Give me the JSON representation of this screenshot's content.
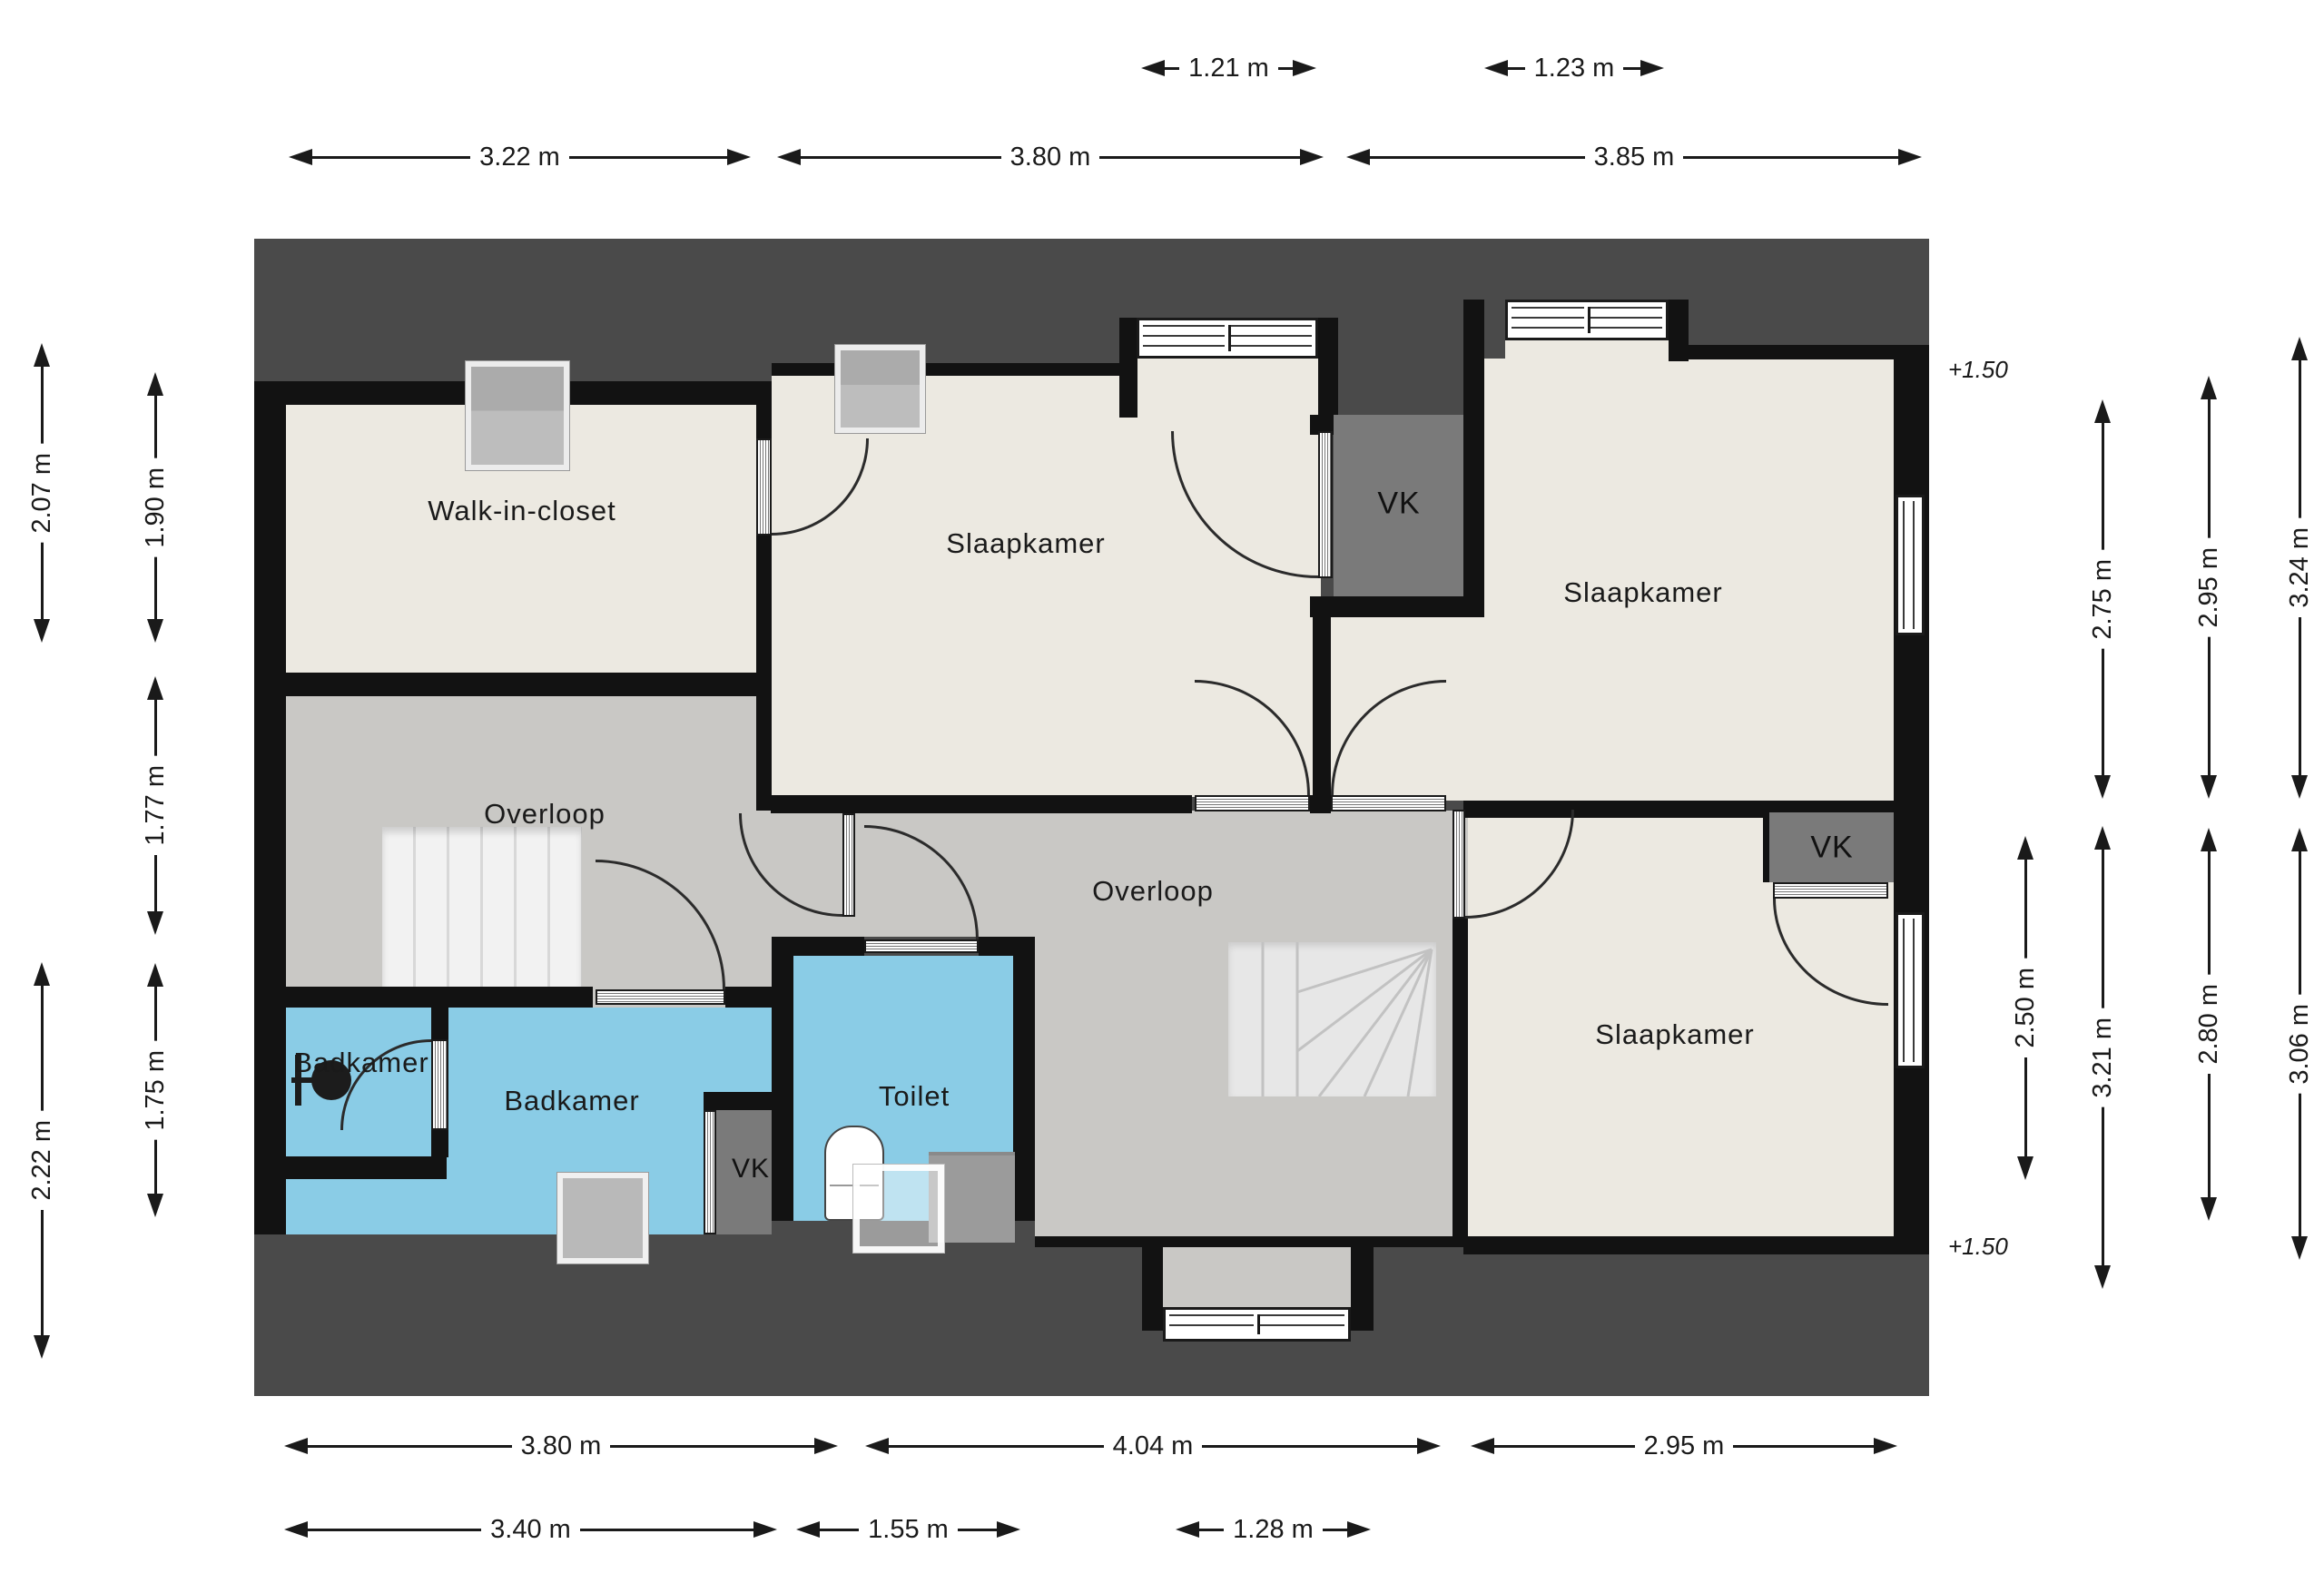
{
  "rooms": {
    "walk_in_closet": "Walk-in-closet",
    "slaapkamer_top": "Slaapkamer",
    "slaapkamer_right": "Slaapkamer",
    "slaapkamer_bottom_right": "Slaapkamer",
    "overloop_left": "Overloop",
    "overloop_center": "Overloop",
    "badkamer_small": "Badkamer",
    "badkamer_main": "Badkamer",
    "toilet": "Toilet"
  },
  "closets": [
    "VK",
    "VK",
    "VK"
  ],
  "level_markers": [
    "+1.50",
    "+1.50"
  ],
  "dims": {
    "t1": [
      "1.21 m",
      "1.23 m"
    ],
    "t2": [
      "3.22 m",
      "3.80 m",
      "3.85 m"
    ],
    "lo": [
      "2.07 m",
      "2.22 m"
    ],
    "li": [
      "1.90 m",
      "1.77 m",
      "1.75 m"
    ],
    "r": [
      "2.50 m",
      "2.75 m",
      "3.21 m",
      "2.95 m",
      "2.80 m",
      "3.24 m",
      "3.06 m"
    ],
    "b1": [
      "3.80 m",
      "4.04 m",
      "2.95 m"
    ],
    "b2": [
      "3.40 m",
      "1.55 m",
      "1.28 m"
    ]
  },
  "colors": {
    "roof": "#4A4A4A",
    "wall": "#121212",
    "room_floor": "#ECE9E1",
    "hall_floor": "#C9C8C5",
    "bathroom_floor": "#8ACCE6",
    "closet_fill": "#7A7A7A",
    "stairs": "#F2F2F2",
    "window": "#FFFFFF",
    "dimension_text": "#1A1A1A"
  }
}
